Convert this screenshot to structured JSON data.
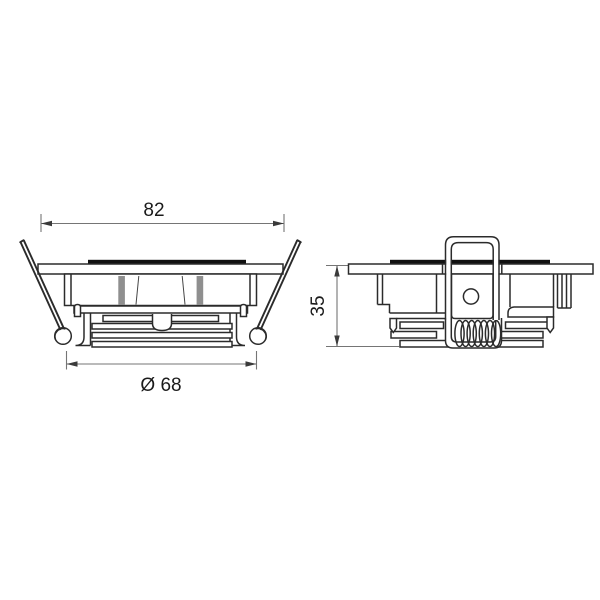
{
  "canvas": {
    "background": "#ffffff",
    "line_color": "#2b2b2b",
    "dimension_line_color": "#757575",
    "text_color": "#1b1b1b"
  },
  "views": {
    "front": {
      "dim_width": "82",
      "dim_diameter": "Ø 68"
    },
    "side": {
      "dim_height": "35"
    }
  }
}
